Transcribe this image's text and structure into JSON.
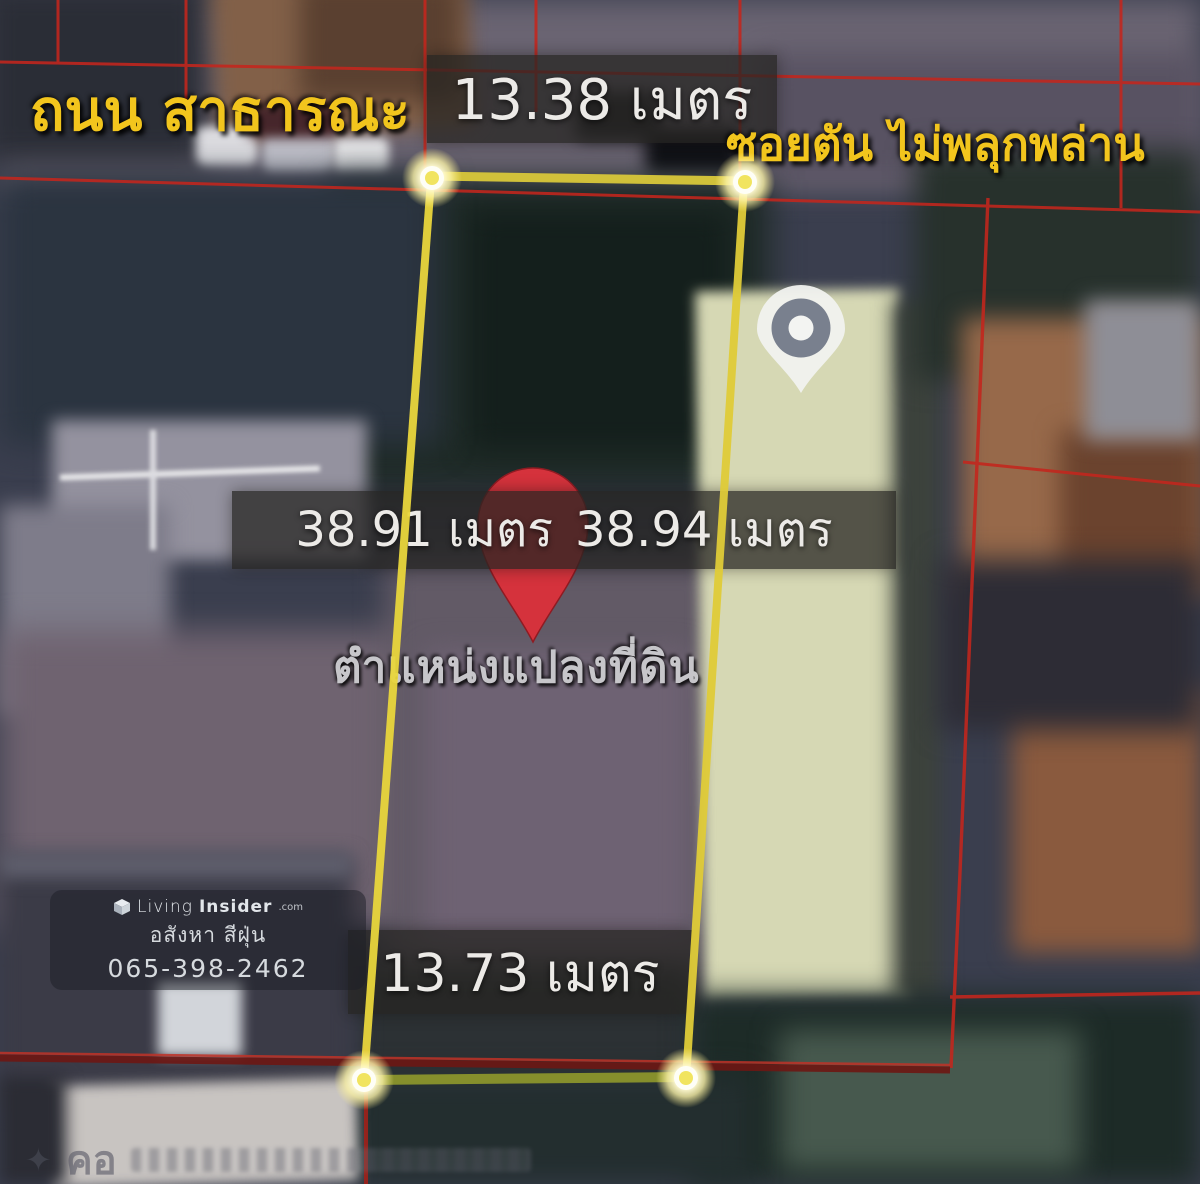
{
  "annotations": {
    "road_label": "ถนน สาธารณะ",
    "soi_label": "ซอยตัน ไม่พลุกพล่าน",
    "plot_position_label": "ตำแหน่งแปลงที่ดิน",
    "measurements": {
      "top": "13.38 เมตร",
      "left": "38.91 เมตร",
      "right": "38.94 เมตร",
      "bottom": "13.73 เมตร"
    }
  },
  "watermark": {
    "brand_light": "Living",
    "brand_bold": "Insider",
    "brand_suffix": ".com",
    "tagline": "อสังหา สีฝุ่น",
    "phone": "065-398-2462"
  },
  "map": {
    "ghost_road_label": "คอ",
    "sparkle": "✦"
  },
  "icons": {
    "red_location_pin": "red teardrop map pin marking the land plot",
    "building_location_pin": "grey/white teardrop pin on neighbouring building",
    "corner_marker": "glowing white-yellow dot at each plot corner",
    "livinginsider_logo": "small 3d cube logo",
    "sparkle": "✦"
  },
  "colors": {
    "annotation_yellow": "#f2c51d",
    "plot_boundary_yellow": "#e8d43c",
    "cadastral_red": "#c4261d",
    "pin_red": "#d5323c",
    "measure_strip_bg": "rgba(38,36,34,0.74)"
  }
}
